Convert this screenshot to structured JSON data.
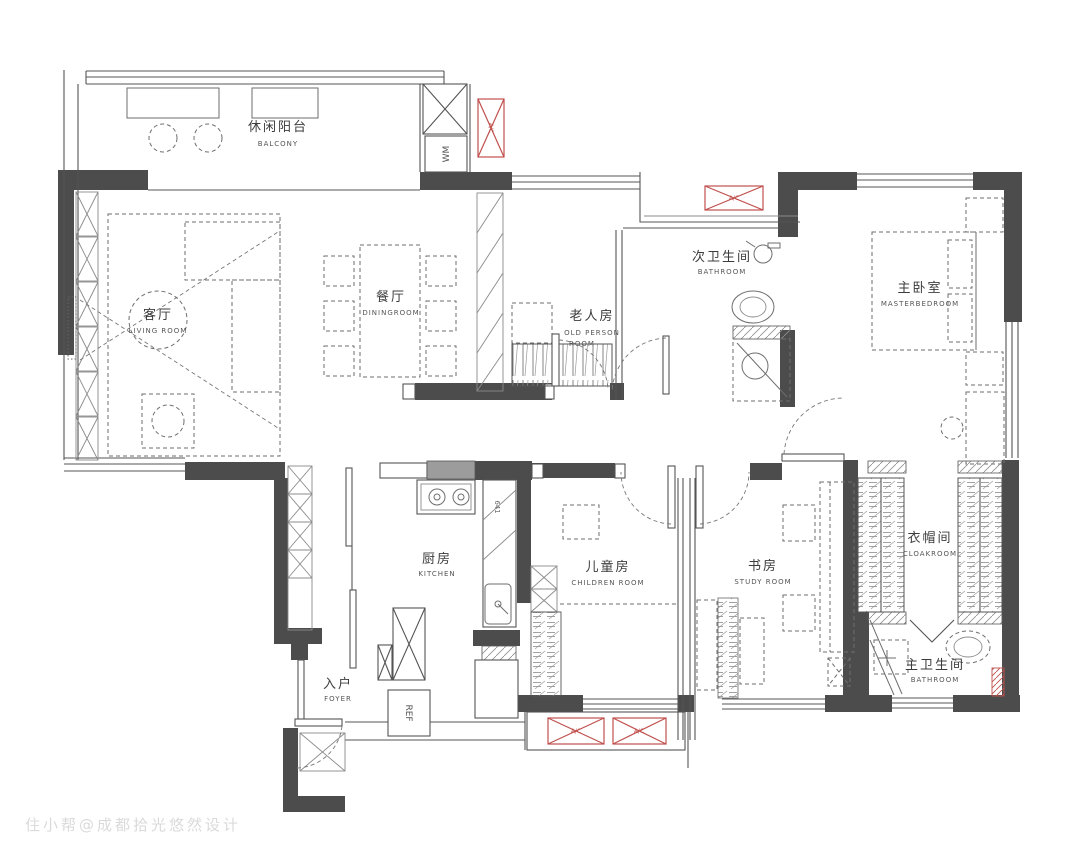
{
  "watermark": "住小帮@成都拾光悠然设计",
  "colors": {
    "wall": "#4c4c4c",
    "thin_line": "#555555",
    "accent_red": "#c0504d",
    "watermark": "#dadada"
  },
  "rooms": {
    "balcony": {
      "zh": "休闲阳台",
      "en": "BALCONY"
    },
    "living": {
      "zh": "客厅",
      "en": "LIVING ROOM"
    },
    "dining": {
      "zh": "餐厅",
      "en": "DININGROOM"
    },
    "elder": {
      "zh": "老人房",
      "en1": "OLD PERSON",
      "en2": "ROOM"
    },
    "bath2": {
      "zh": "次卫生间",
      "en": "BATHROOM"
    },
    "master": {
      "zh": "主卧室",
      "en": "MASTERBEDROOM"
    },
    "kitchen": {
      "zh": "厨房",
      "en": "KITCHEN"
    },
    "foyer": {
      "zh": "入户",
      "en": "FOYER"
    },
    "children": {
      "zh": "儿童房",
      "en": "CHILDREN ROOM"
    },
    "study": {
      "zh": "书房",
      "en": "STUDY ROOM"
    },
    "cloak": {
      "zh": "衣帽间",
      "en": "CLOAKROOM"
    },
    "bath1": {
      "zh": "主卫生间",
      "en": "BATHROOM"
    }
  },
  "appliances": {
    "washing_machine": "WM",
    "refrigerator": "REF",
    "air_conditioner": "A/C"
  },
  "dimensions": {
    "kitchen_counter": "641"
  }
}
